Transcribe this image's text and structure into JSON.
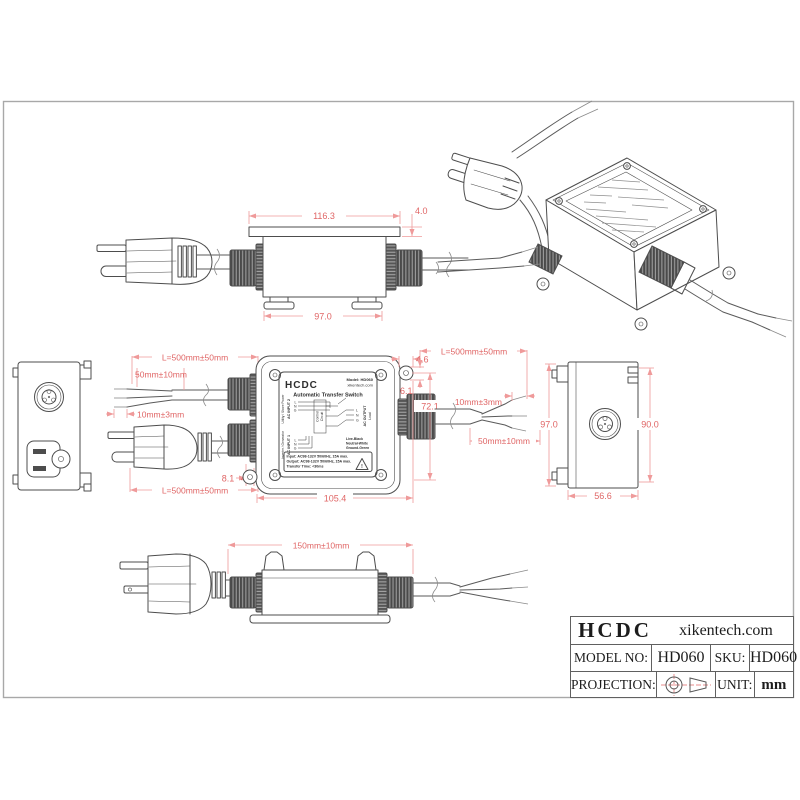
{
  "colors": {
    "line": "#4d4d4d",
    "dim_line": "#ef9a9a",
    "dim_text": "#e06666"
  },
  "dims": {
    "top_width": "116.3",
    "lid_thickness": "4.0",
    "feet_span": "97.0",
    "cord_top_left": "L=500mm±50mm",
    "strip_left": "50mm±10mm",
    "tip_left": "10mm±3mm",
    "cord_bottom_left": "L=500mm±50mm",
    "gap_8_1": "8.1",
    "gap_4_6": "4.6",
    "front_width": "105.4",
    "ear_width": "4.6",
    "ear_height": "6.1",
    "front_height": "72.1",
    "cord_right": "L=500mm±50mm",
    "tip_right": "10mm±3mm",
    "strip_right": "50mm±10mm",
    "side_height": "97.0",
    "side_inner_height": "90.0",
    "side_width": "56.6",
    "body_length": "150mm±10mm"
  },
  "label": {
    "brand": "HCDC",
    "model": "Model: HD060",
    "site": "xikentech.com",
    "title": "Automatic Transfer Switch",
    "input2": "AC INPUT 2",
    "input2_src": "Utility / Shore Power",
    "input1": "AC INPUT 1",
    "input1_src": "Inverter / Generator",
    "output": "AC OUTPUT",
    "load": "Load",
    "control_1": "Control",
    "control_2": "Circuit",
    "terminals": [
      "L",
      "N",
      "G"
    ],
    "wire1": "Live-Black",
    "wire2": "Neutral-White",
    "wire3": "Ground-Green",
    "spec1": "Input: AC98-132V 50/60Hz, 15A max.",
    "spec2": "Output: AC98-132V 50/60Hz, 15A max.",
    "spec3": "Transfer Time: <30ms",
    "warn": "!"
  },
  "title_block": {
    "brand": "HCDC",
    "website": "xikentech.com",
    "model_label": "MODEL NO:",
    "model_value": "HD060",
    "sku_label": "SKU:",
    "sku_value": "HD060",
    "projection_label": "PROJECTION:",
    "unit_label": "UNIT:",
    "unit_value": "mm"
  }
}
